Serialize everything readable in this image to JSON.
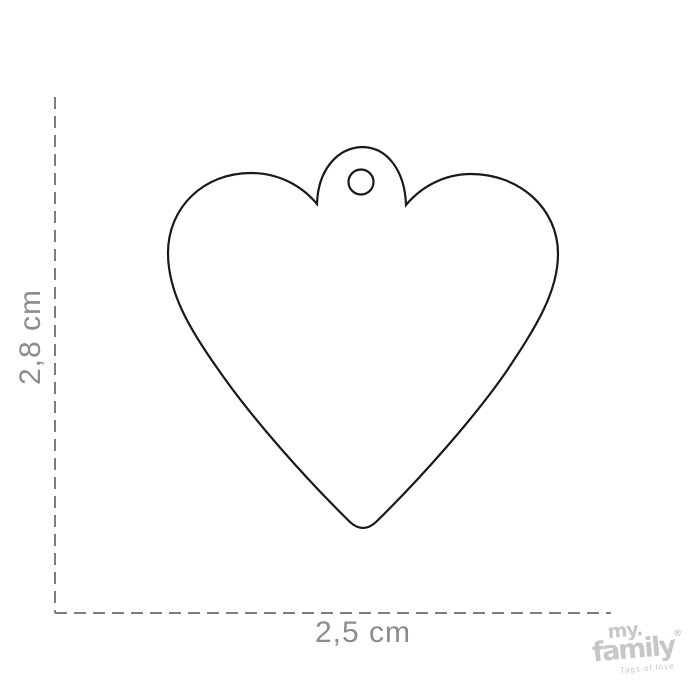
{
  "diagram": {
    "title": "heart-shaped tag size diagram",
    "height_label": "2,8 cm",
    "width_label": "2,5 cm"
  },
  "branding": {
    "line1": "my",
    "dot": ".",
    "line2": "family",
    "registered_mark": "®",
    "tagline": "Tags of love"
  },
  "colors": {
    "background": "#ffffff",
    "shape_outline": "#1a1a1a",
    "shape_fill": "#ffffff",
    "dashed_line": "#7d7d7d",
    "dimension_text": "#8c8c8c",
    "logo_text": "#c7c7c7"
  }
}
